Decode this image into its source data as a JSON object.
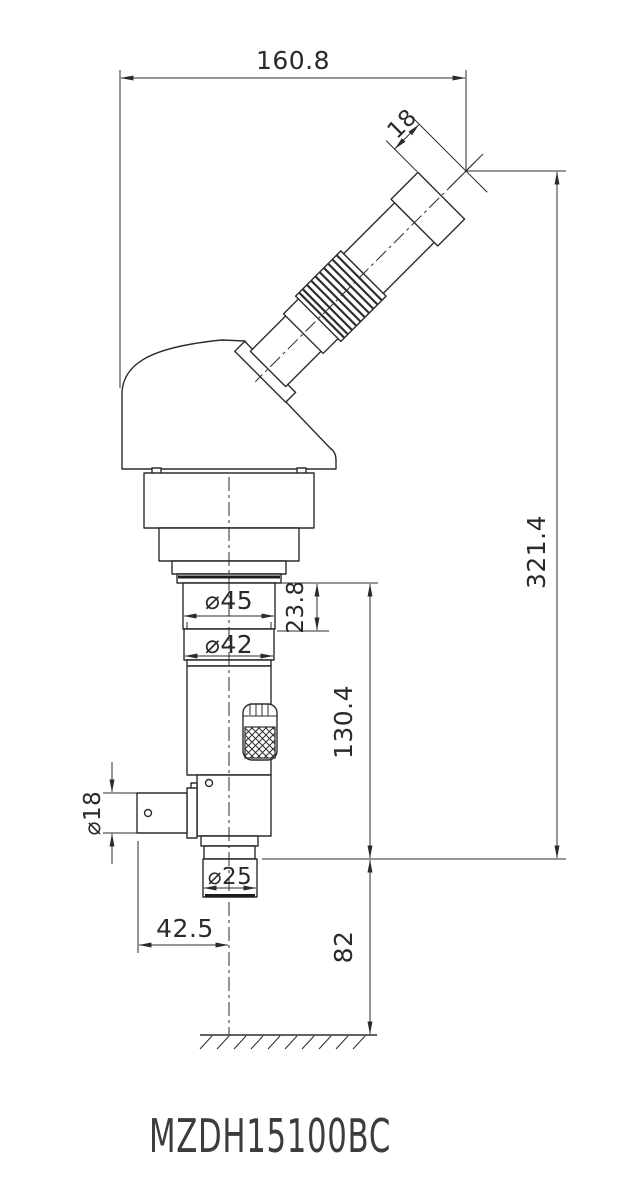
{
  "drawing": {
    "model": "MZDH15100BC",
    "type_label": "monocular zoom microscope outline drawing",
    "colors": {
      "line": "#2d2d2d",
      "background": "#ffffff"
    },
    "dimensions": {
      "total_width": "160.8",
      "eye_relief": "18",
      "total_height": "321.4",
      "flange_section_height": "23.8",
      "body_diameter_45": "⌀45",
      "body_diameter_42": "⌀42",
      "lower_body_height": "130.4",
      "side_port_diameter": "⌀18",
      "mount_spigot_diameter": "⌀25",
      "side_port_offset": "42.5",
      "mount_height": "82"
    }
  }
}
